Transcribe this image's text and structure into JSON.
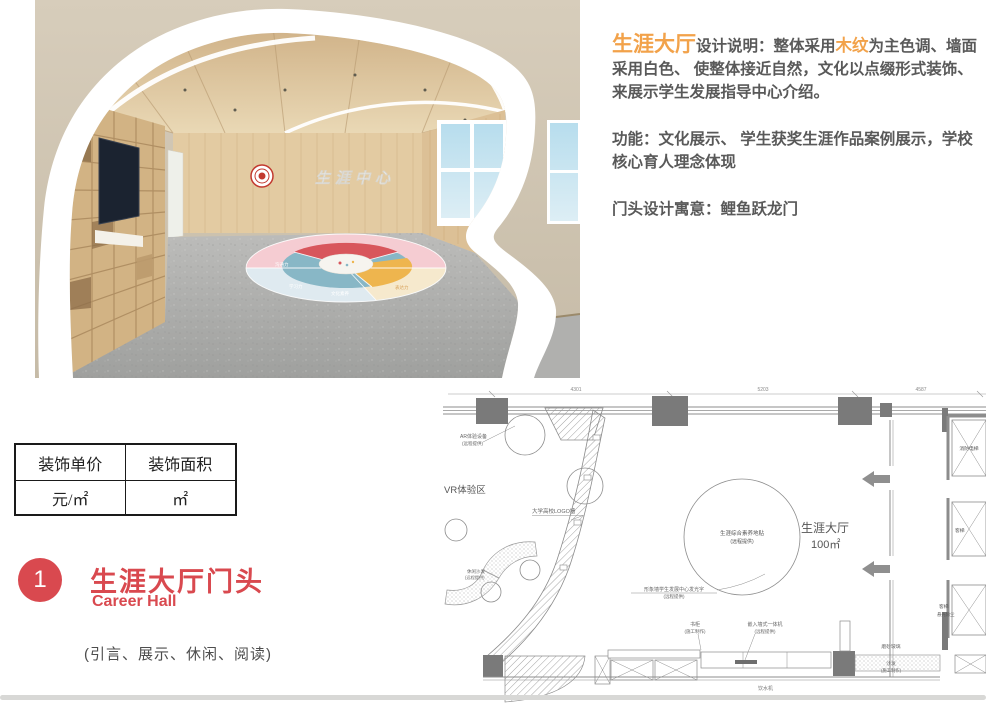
{
  "render": {
    "wall_logo_text": "生涯中心",
    "decal_labels": [
      "沟通力",
      "学习力",
      "文化素养",
      "表达力"
    ],
    "colors": {
      "wall_beige": "#cdc2ae",
      "wood": "#dcc096",
      "floor_gray": "#b6b6b4",
      "logo_red": "#c2392f"
    }
  },
  "description": {
    "title_highlight": "生涯大厅",
    "intro_label": "设计说明：整体采用",
    "wood_highlight": "木纹",
    "intro_rest": "为主色调、墙面采用白色、 使整体接近自然，文化以点缀形式装饰、 来展示学生发展指导中心介绍。",
    "function_text": "功能：文化展示、 学生获奖生涯作品案例展示，学校核心育人理念体现",
    "meaning_text": "门头设计寓意：鲤鱼跃龙门"
  },
  "price_table": {
    "headers": [
      "装饰单价",
      "装饰面积"
    ],
    "values": [
      "元/㎡",
      "㎡"
    ]
  },
  "section": {
    "number": "1",
    "title": "生涯大厅门头",
    "subtitle": "Career Hall",
    "note": "(引言、展示、休闲、阅读)"
  },
  "plan": {
    "dimensions": [
      "4301",
      "5203",
      "4587"
    ],
    "labels": {
      "ar_device": "AR体验设备",
      "remote": "(远程提供)",
      "vr_zone": "VR体验区",
      "logo_wall": "大学高校LOGO墙",
      "leisure_sofa": "休闲沙发",
      "floor_sticker": "生涯综合素养地贴",
      "hall_name": "生涯大厅",
      "hall_area": "100㎡",
      "image_wall": "形象墙学生发展中心发光字",
      "bookcase": "书柜",
      "construction": "(施工制作)",
      "aio_machine": "嵌入墙式一体机",
      "frosted_glass": "磨砂玻璃",
      "sofa": "沙发",
      "water_dispenser": "饮水机",
      "fire_elevator": "消防电梯",
      "elevator": "客梯",
      "elevator_note": "悬光除尘"
    }
  },
  "colors": {
    "accent_orange": "#F2A24A",
    "accent_red": "#D9494F",
    "text_dark": "#595959",
    "plan_line": "#8c8c8c"
  }
}
